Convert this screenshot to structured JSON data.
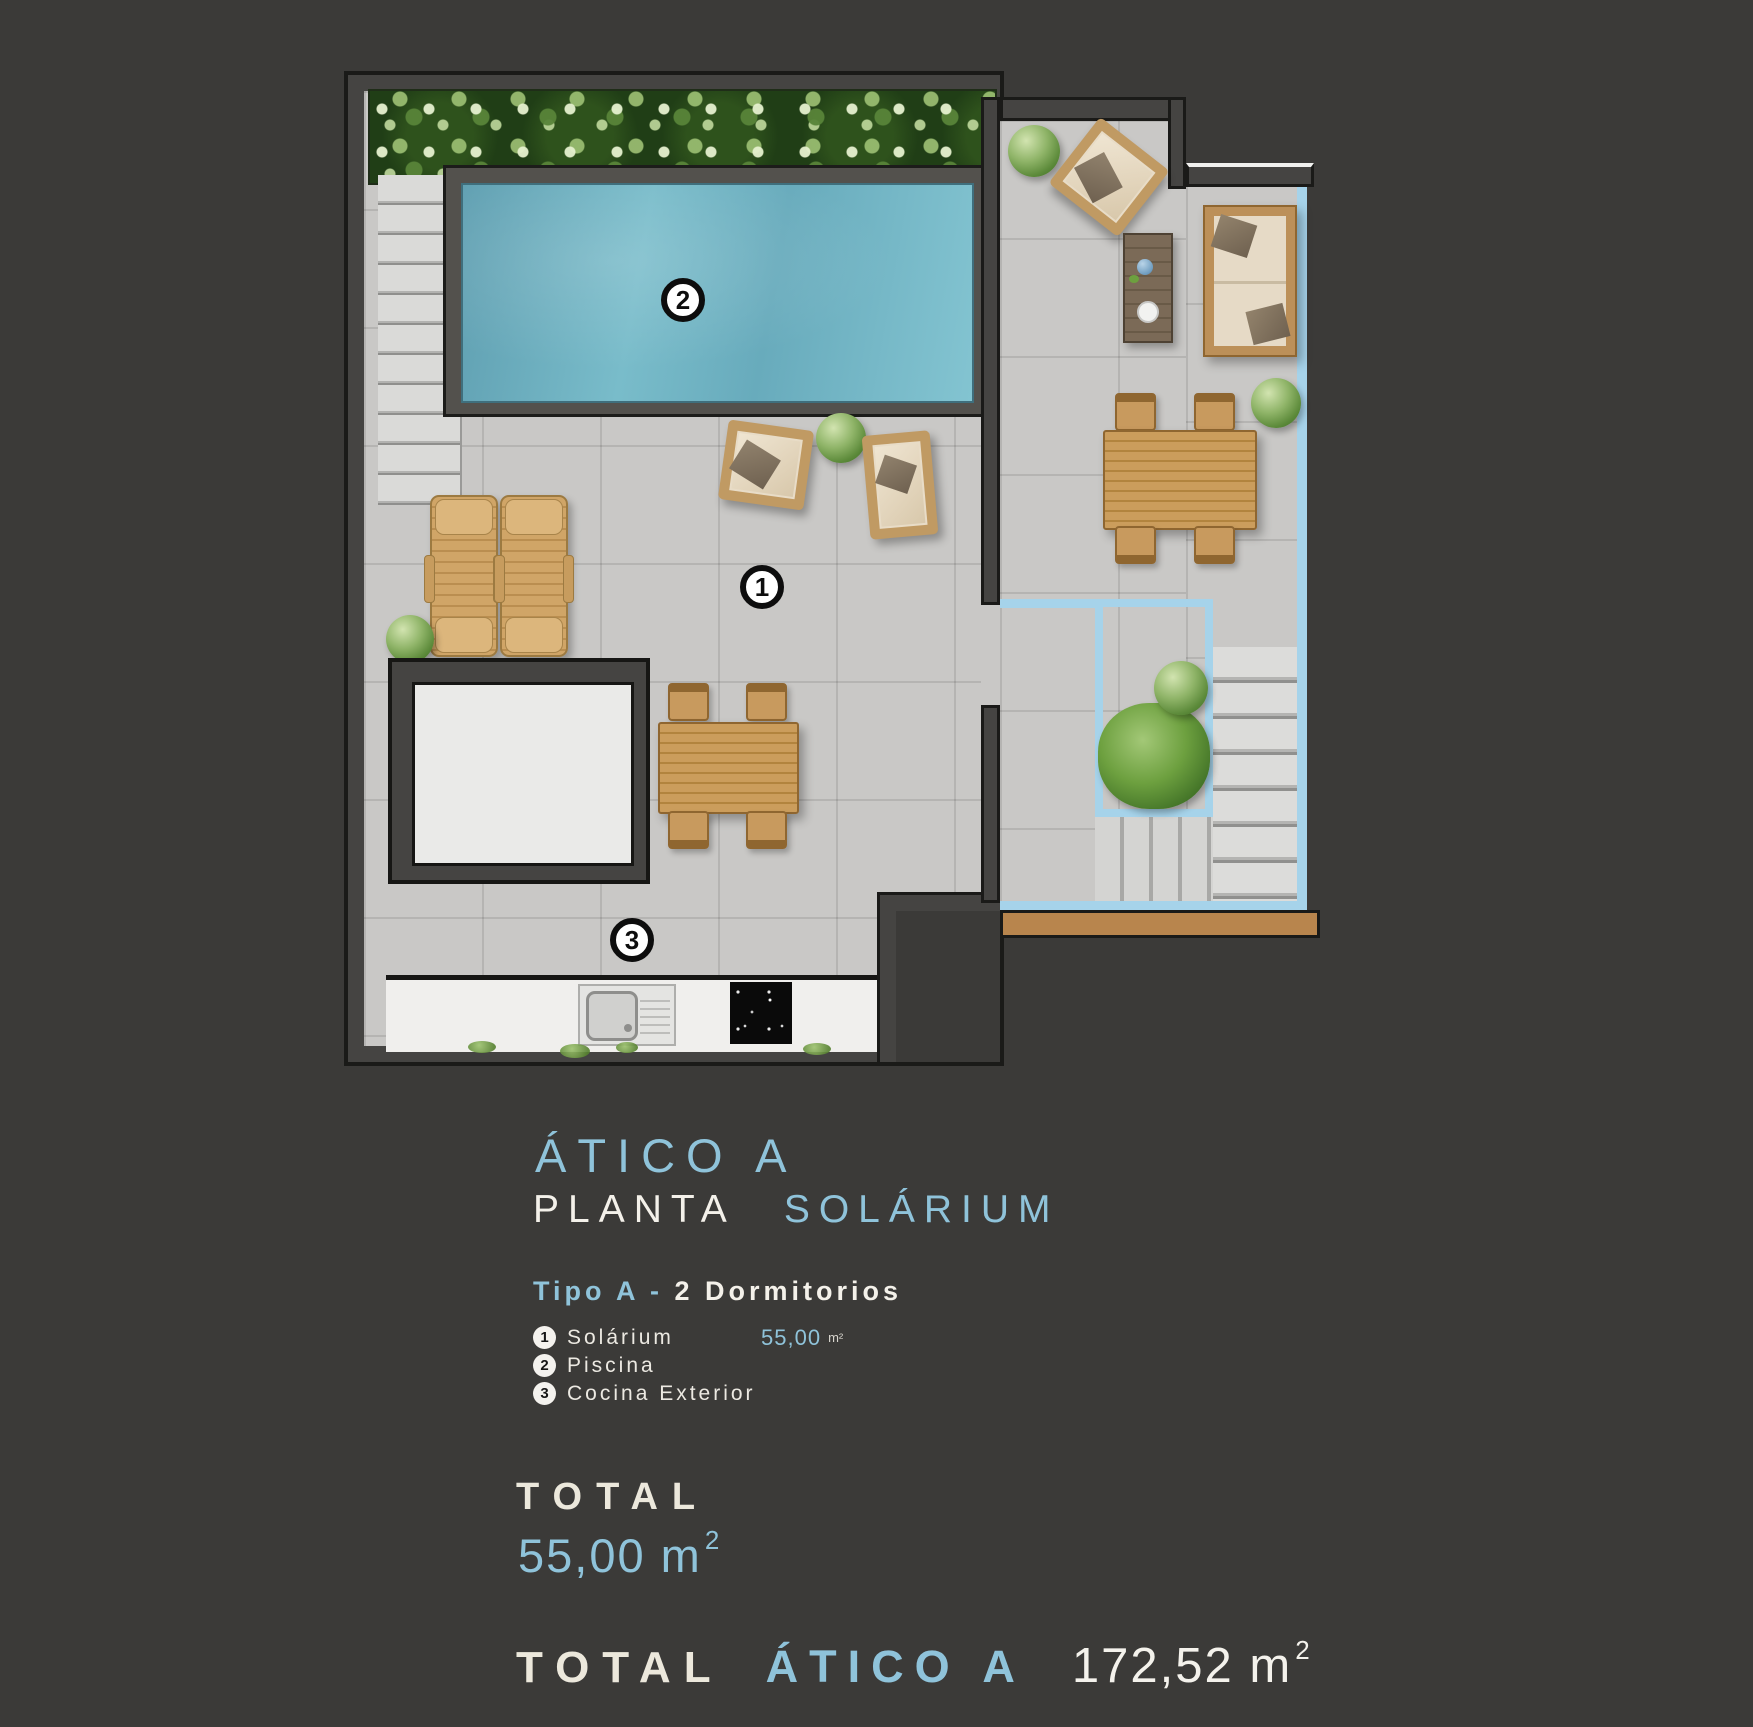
{
  "colors": {
    "background": "#3b3a38",
    "accent_blue": "#8fc3da",
    "text_white": "#f4f1ea",
    "text_cream": "#ece8dc",
    "pool_water": "#74b7c8",
    "balustrade_blue": "#a6d3ea",
    "wall_gray": "#454442",
    "terrace_tile": "#c9c8c6",
    "wood": "#c49257"
  },
  "plan": {
    "markers": {
      "solarium": "1",
      "piscina": "2",
      "cocina": "3"
    }
  },
  "info": {
    "title": "ÁTICO A",
    "subtitle": {
      "white": "PLANTA",
      "blue": "SOLÁRIUM"
    },
    "type": {
      "blue": "Tipo A -",
      "white": "2 Dormitorios"
    },
    "legend": [
      {
        "num": "1",
        "label": "Solárium",
        "area": "55,00",
        "unit": "m²"
      },
      {
        "num": "2",
        "label": "Piscina",
        "area": "",
        "unit": ""
      },
      {
        "num": "3",
        "label": "Cocina Exterior",
        "area": "",
        "unit": ""
      }
    ],
    "total": {
      "label": "TOTAL",
      "value": "55,00 m",
      "sup": "2"
    },
    "grand_total": {
      "label": "TOTAL",
      "name": "ÁTICO A",
      "value": "172,52 m",
      "sup": "2"
    }
  }
}
